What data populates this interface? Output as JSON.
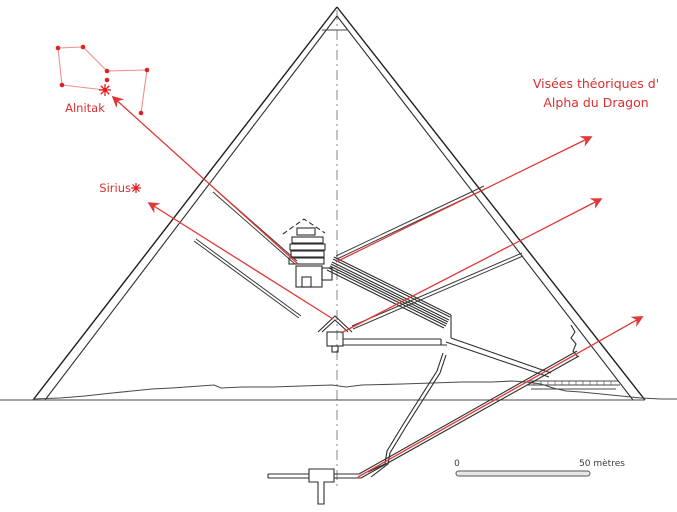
{
  "labels": {
    "alnitak": "Alnitak",
    "sirius": "Sirius",
    "visees_line1": "Visées théoriques d'",
    "visees_line2": "Alpha du Dragon"
  },
  "scale_bar": {
    "start_label": "0",
    "end_label": "50 mètres"
  },
  "colors": {
    "sight_line": "#e03838",
    "constellation_line": "#ef8f8f",
    "star": "#e02020",
    "label_red": "#d93030",
    "scale_text": "#3a3a3a"
  },
  "constellation": {
    "name": "orion",
    "stars": [
      {
        "x": 58,
        "y": 48,
        "major": false
      },
      {
        "x": 83,
        "y": 47,
        "major": false
      },
      {
        "x": 107,
        "y": 71,
        "major": false
      },
      {
        "x": 147,
        "y": 70,
        "major": false
      },
      {
        "x": 62,
        "y": 85,
        "major": false
      },
      {
        "x": 107,
        "y": 80,
        "major": false
      },
      {
        "x": 105,
        "y": 90,
        "major": true
      },
      {
        "x": 141,
        "y": 113,
        "major": false
      }
    ],
    "edges": [
      [
        0,
        1
      ],
      [
        1,
        2
      ],
      [
        2,
        3
      ],
      [
        3,
        7
      ],
      [
        0,
        4
      ],
      [
        4,
        6
      ]
    ]
  },
  "star_symbols": [
    {
      "name": "sirius-star",
      "x": 136,
      "y": 188,
      "size": 5
    }
  ],
  "sight_lines": [
    {
      "name": "kings-chamber-south-shaft-to-alnitak",
      "x1": 298,
      "y1": 264,
      "x2": 113,
      "y2": 97
    },
    {
      "name": "queens-chamber-south-shaft-to-sirius",
      "x1": 333,
      "y1": 319,
      "x2": 149,
      "y2": 203
    },
    {
      "name": "kings-chamber-north-shaft-to-alpha-draconis",
      "x1": 336,
      "y1": 262,
      "x2": 591,
      "y2": 137
    },
    {
      "name": "queens-chamber-north-shaft-to-alpha-draconis",
      "x1": 341,
      "y1": 333,
      "x2": 601,
      "y2": 199
    },
    {
      "name": "descending-passage-to-alpha-draconis",
      "x1": 358,
      "y1": 477,
      "x2": 642,
      "y2": 317
    }
  ]
}
